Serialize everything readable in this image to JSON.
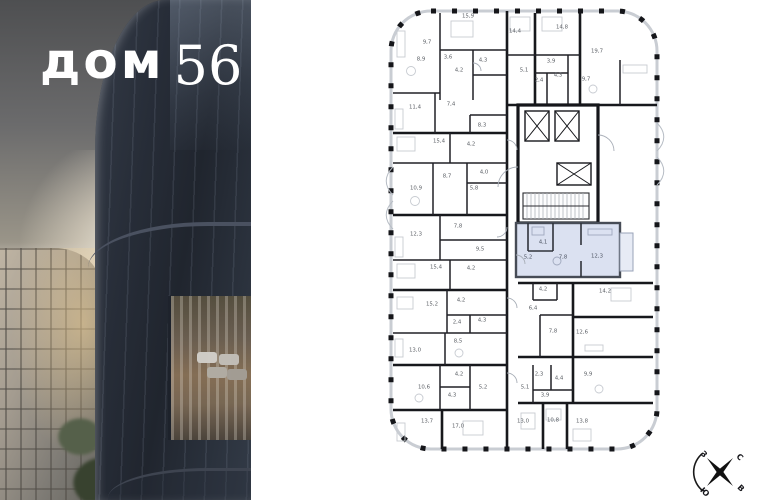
{
  "brand": {
    "logo_word": "дом",
    "logo_number": "56"
  },
  "floorplan": {
    "highlight_color": "#dbe1f1",
    "rooms": [
      {
        "label": "9,7",
        "x": 42,
        "y": 38
      },
      {
        "label": "15,9",
        "x": 83,
        "y": 12
      },
      {
        "label": "14,4",
        "x": 130,
        "y": 27
      },
      {
        "label": "14,8",
        "x": 177,
        "y": 23
      },
      {
        "label": "19,7",
        "x": 212,
        "y": 47
      },
      {
        "label": "8,9",
        "x": 36,
        "y": 55
      },
      {
        "label": "3,6",
        "x": 63,
        "y": 53
      },
      {
        "label": "4,3",
        "x": 98,
        "y": 56
      },
      {
        "label": "4,2",
        "x": 74,
        "y": 66
      },
      {
        "label": "5,1",
        "x": 139,
        "y": 66
      },
      {
        "label": "3,9",
        "x": 166,
        "y": 57
      },
      {
        "label": "2,4",
        "x": 154,
        "y": 76
      },
      {
        "label": "4,3",
        "x": 173,
        "y": 71
      },
      {
        "label": "9,7",
        "x": 201,
        "y": 75
      },
      {
        "label": "11,4",
        "x": 30,
        "y": 103
      },
      {
        "label": "7,4",
        "x": 66,
        "y": 100
      },
      {
        "label": "8,3",
        "x": 97,
        "y": 121
      },
      {
        "label": "15,4",
        "x": 54,
        "y": 137
      },
      {
        "label": "4,2",
        "x": 86,
        "y": 140
      },
      {
        "label": "8,7",
        "x": 62,
        "y": 172
      },
      {
        "label": "4,0",
        "x": 99,
        "y": 168
      },
      {
        "label": "10,9",
        "x": 31,
        "y": 184
      },
      {
        "label": "5,8",
        "x": 89,
        "y": 184
      },
      {
        "label": "12,3",
        "x": 31,
        "y": 230
      },
      {
        "label": "7,8",
        "x": 73,
        "y": 222
      },
      {
        "label": "9,5",
        "x": 95,
        "y": 245
      },
      {
        "label": "4,1",
        "x": 158,
        "y": 238,
        "hl": true
      },
      {
        "label": "5,2",
        "x": 143,
        "y": 253,
        "hl": true
      },
      {
        "label": "7,8",
        "x": 178,
        "y": 253,
        "hl": true
      },
      {
        "label": "12,3",
        "x": 212,
        "y": 252,
        "hl": true
      },
      {
        "label": "15,4",
        "x": 51,
        "y": 263
      },
      {
        "label": "4,2",
        "x": 86,
        "y": 264
      },
      {
        "label": "15,2",
        "x": 47,
        "y": 300
      },
      {
        "label": "4,2",
        "x": 76,
        "y": 296
      },
      {
        "label": "2,4",
        "x": 72,
        "y": 318
      },
      {
        "label": "4,3",
        "x": 97,
        "y": 316
      },
      {
        "label": "13,0",
        "x": 30,
        "y": 346
      },
      {
        "label": "8,5",
        "x": 73,
        "y": 337
      },
      {
        "label": "4,2",
        "x": 158,
        "y": 285
      },
      {
        "label": "14,2",
        "x": 220,
        "y": 287
      },
      {
        "label": "6,4",
        "x": 148,
        "y": 304
      },
      {
        "label": "7,8",
        "x": 168,
        "y": 327
      },
      {
        "label": "12,6",
        "x": 197,
        "y": 328
      },
      {
        "label": "4,2",
        "x": 74,
        "y": 370
      },
      {
        "label": "10,6",
        "x": 39,
        "y": 383
      },
      {
        "label": "4,3",
        "x": 67,
        "y": 391
      },
      {
        "label": "5,2",
        "x": 98,
        "y": 383
      },
      {
        "label": "5,1",
        "x": 140,
        "y": 383
      },
      {
        "label": "2,3",
        "x": 154,
        "y": 370
      },
      {
        "label": "4,4",
        "x": 174,
        "y": 374
      },
      {
        "label": "9,9",
        "x": 203,
        "y": 370
      },
      {
        "label": "3,9",
        "x": 160,
        "y": 391
      },
      {
        "label": "13,7",
        "x": 42,
        "y": 417
      },
      {
        "label": "17,0",
        "x": 73,
        "y": 422
      },
      {
        "label": "13,0",
        "x": 138,
        "y": 417
      },
      {
        "label": "10,8",
        "x": 168,
        "y": 416
      },
      {
        "label": "13,8",
        "x": 197,
        "y": 417
      }
    ]
  },
  "compass": {
    "ne": "С",
    "se": "В",
    "sw": "Ю",
    "nw": "З"
  }
}
